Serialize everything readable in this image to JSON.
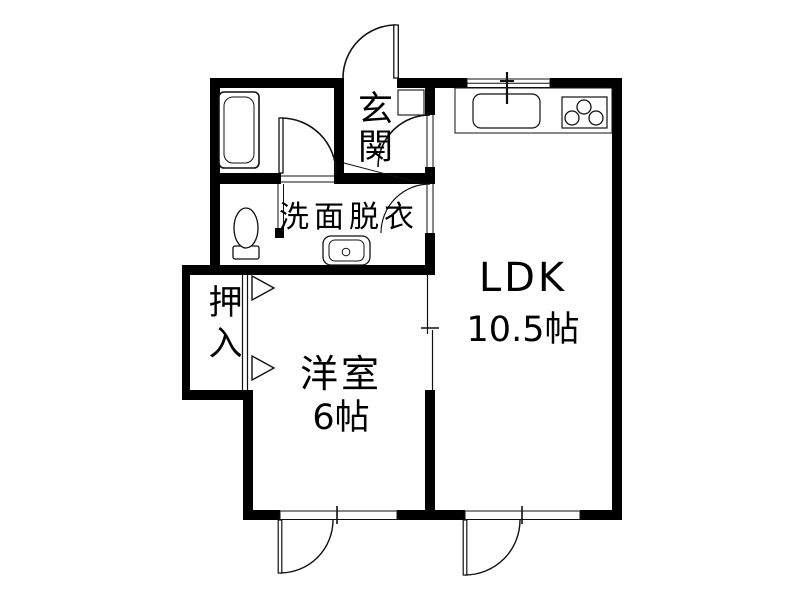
{
  "floorplan": {
    "type": "japanese-apartment-floor-plan",
    "rooms": {
      "genkan": {
        "label": "玄関"
      },
      "washroom": {
        "label": "洗面脱衣"
      },
      "ldk": {
        "label": "LDK",
        "area": "10.5帖"
      },
      "western_room": {
        "label": "洋室",
        "area": "6帖"
      },
      "closet": {
        "label": "押入"
      }
    },
    "fixtures": [
      "bathtub",
      "toilet",
      "washbasin",
      "kitchen-counter",
      "kitchen-sink",
      "faucet",
      "gas-stove-3-burner",
      "shoe-cabinet"
    ],
    "door_symbols": [
      "entrance-swing-door",
      "bathroom-swing-door",
      "genkan-ldk-swing-door",
      "washroom-ldk-swing-door",
      "closet-sliding-door",
      "room-ldk-sliding-door",
      "terrace-swing-window-west-room",
      "terrace-swing-window-ldk"
    ],
    "colors": {
      "wall": "#000000",
      "background": "#ffffff",
      "line": "#111111"
    }
  }
}
